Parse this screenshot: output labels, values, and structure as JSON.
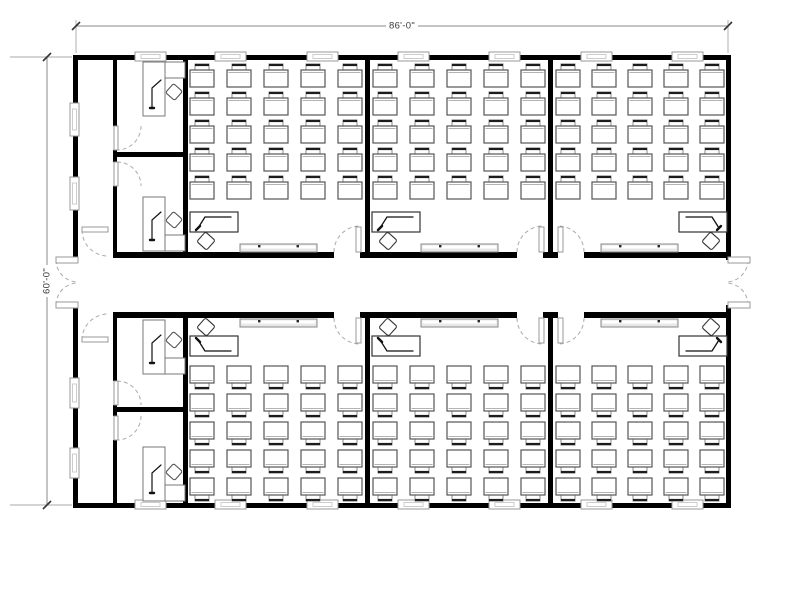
{
  "meta": {
    "drawing_type": "architectural floor plan",
    "building": "6-classroom modular building with central corridor and 4 offices"
  },
  "dimensions": {
    "top_label": "86'-0\"",
    "left_label": "60'-0\""
  },
  "colors": {
    "bg": "#ffffff",
    "wall": "#000000",
    "desk_stroke": "#555555",
    "desk_inner": "#9a9a9a",
    "chair_stroke": "#8a8a8a",
    "chair_back": "#1c1c1c",
    "teacher_stroke": "#333333",
    "arm_stroke": "#111111",
    "window_stroke": "#999999",
    "window_inner": "#cccccc",
    "door_stroke": "#999999",
    "arc_stroke": "#aaaaaa",
    "board_stroke": "#888888",
    "board_fill": "#e8e8e8",
    "board_dot": "#222222",
    "dim_line": "#888888",
    "dim_ext": "#aaaaaa",
    "dim_tick": "#333333"
  },
  "desk": {
    "w": 24,
    "h": 17,
    "chair_w": 14,
    "chair_h": 8
  },
  "walls": [
    [
      73,
      55,
      658,
      5
    ],
    [
      73,
      503,
      658,
      5
    ],
    [
      73,
      55,
      5,
      205
    ],
    [
      73,
      305,
      5,
      203
    ],
    [
      726,
      55,
      5,
      205
    ],
    [
      726,
      305,
      5,
      203
    ],
    [
      113,
      252,
      221,
      6
    ],
    [
      360,
      252,
      157,
      6
    ],
    [
      543,
      252,
      15,
      6
    ],
    [
      584,
      252,
      142,
      6
    ],
    [
      113,
      312,
      221,
      6
    ],
    [
      360,
      312,
      157,
      6
    ],
    [
      543,
      312,
      15,
      6
    ],
    [
      584,
      312,
      142,
      6
    ],
    [
      113,
      60,
      4,
      66
    ],
    [
      113,
      150,
      4,
      12
    ],
    [
      113,
      186,
      4,
      66
    ],
    [
      113,
      318,
      4,
      63
    ],
    [
      113,
      405,
      4,
      11
    ],
    [
      113,
      440,
      4,
      63
    ],
    [
      183,
      60,
      5,
      192
    ],
    [
      183,
      318,
      5,
      185
    ],
    [
      365,
      60,
      5,
      192
    ],
    [
      365,
      318,
      5,
      185
    ],
    [
      548,
      60,
      5,
      192
    ],
    [
      548,
      318,
      5,
      185
    ],
    [
      113,
      152,
      75,
      5
    ],
    [
      113,
      407,
      75,
      5
    ]
  ],
  "windows": [
    [
      135,
      52,
      31,
      9
    ],
    [
      215,
      52,
      31,
      9
    ],
    [
      307,
      52,
      31,
      9
    ],
    [
      398,
      52,
      31,
      9
    ],
    [
      489,
      52,
      31,
      9
    ],
    [
      581,
      52,
      31,
      9
    ],
    [
      672,
      52,
      31,
      9
    ],
    [
      135,
      500,
      31,
      9
    ],
    [
      215,
      500,
      31,
      9
    ],
    [
      307,
      500,
      31,
      9
    ],
    [
      398,
      500,
      31,
      9
    ],
    [
      489,
      500,
      31,
      9
    ],
    [
      581,
      500,
      31,
      9
    ],
    [
      672,
      500,
      31,
      9
    ],
    [
      70,
      103,
      9,
      33
    ],
    [
      70,
      177,
      9,
      33
    ],
    [
      70,
      378,
      9,
      30
    ],
    [
      70,
      448,
      9,
      30
    ]
  ],
  "door_leaves": [
    [
      356,
      227,
      5,
      25
    ],
    [
      539,
      227,
      5,
      25
    ],
    [
      558,
      227,
      5,
      25
    ],
    [
      356,
      318,
      5,
      25
    ],
    [
      539,
      318,
      5,
      25
    ],
    [
      558,
      318,
      5,
      25
    ],
    [
      114,
      126,
      4,
      24
    ],
    [
      114,
      162,
      4,
      24
    ],
    [
      114,
      381,
      4,
      24
    ],
    [
      114,
      416,
      4,
      24
    ],
    [
      82,
      227,
      26,
      5
    ],
    [
      82,
      337,
      26,
      5
    ],
    [
      56,
      257,
      22,
      6
    ],
    [
      56,
      302,
      22,
      6
    ],
    [
      728,
      257,
      22,
      6
    ],
    [
      728,
      302,
      22,
      6
    ]
  ],
  "door_arcs": [
    "M 334 252 A 26 26 0 0 1 360 226",
    "M 517 252 A 26 26 0 0 1 543 226",
    "M 584 252 A 26 26 0 0 0 558 226",
    "M 334 318 A 26 26 0 0 0 360 344",
    "M 517 318 A 26 26 0 0 0 543 344",
    "M 584 318 A 26 26 0 0 1 558 344",
    "M 141 126 A 24 24 0 0 1 117 150",
    "M 117 162 A 24 24 0 0 1 141 186",
    "M 117 381 A 24 24 0 0 1 141 405",
    "M 141 416 A 24 24 0 0 1 117 440",
    "M 82 230 A 26 26 0 0 0 108 256",
    "M 82 340 A 26 26 0 0 1 108 314",
    "M 56 260 A 22 22 0 0 0 78 282",
    "M 56 305 A 22 22 0 0 1 78 283",
    "M 748 260 A 22 22 0 0 1 726 282",
    "M 748 305 A 22 22 0 0 0 726 283"
  ],
  "whiteboards": {
    "w": 77,
    "h": 8,
    "items": [
      [
        240,
        244
      ],
      [
        421,
        244
      ],
      [
        601,
        244
      ],
      [
        240,
        319
      ],
      [
        421,
        319
      ],
      [
        601,
        319
      ]
    ]
  },
  "classrooms": [
    {
      "id": "classroom-1",
      "chair_side": "top",
      "cols": [
        190,
        227,
        264,
        301,
        338
      ],
      "rows": [
        70,
        98,
        126,
        154,
        182
      ],
      "teacher": {
        "desk": [
          190,
          212,
          48,
          20
        ],
        "chair": [
          206,
          241
        ],
        "hand": "left"
      }
    },
    {
      "id": "classroom-2",
      "chair_side": "top",
      "cols": [
        373,
        410,
        447,
        484,
        521
      ],
      "rows": [
        70,
        98,
        126,
        154,
        182
      ],
      "teacher": {
        "desk": [
          372,
          212,
          48,
          20
        ],
        "chair": [
          388,
          241
        ],
        "hand": "left"
      }
    },
    {
      "id": "classroom-3",
      "chair_side": "top",
      "cols": [
        556,
        592,
        628,
        664,
        700
      ],
      "rows": [
        70,
        98,
        126,
        154,
        182
      ],
      "teacher": {
        "desk": [
          679,
          212,
          48,
          20
        ],
        "chair": [
          711,
          241
        ],
        "hand": "right"
      }
    },
    {
      "id": "classroom-4",
      "chair_side": "bottom",
      "cols": [
        190,
        227,
        264,
        301,
        338
      ],
      "rows": [
        366,
        394,
        422,
        450,
        478
      ],
      "teacher": {
        "desk": [
          190,
          336,
          48,
          20
        ],
        "chair": [
          206,
          327
        ],
        "hand": "left"
      }
    },
    {
      "id": "classroom-5",
      "chair_side": "bottom",
      "cols": [
        373,
        410,
        447,
        484,
        521
      ],
      "rows": [
        366,
        394,
        422,
        450,
        478
      ],
      "teacher": {
        "desk": [
          372,
          336,
          48,
          20
        ],
        "chair": [
          388,
          327
        ],
        "hand": "left"
      }
    },
    {
      "id": "classroom-6",
      "chair_side": "bottom",
      "cols": [
        556,
        592,
        628,
        664,
        700
      ],
      "rows": [
        366,
        394,
        422,
        450,
        478
      ],
      "teacher": {
        "desk": [
          679,
          336,
          48,
          20
        ],
        "chair": [
          711,
          327
        ],
        "hand": "right"
      }
    }
  ],
  "offices": [
    {
      "id": "office-1",
      "v_desk": [
        143,
        62,
        22,
        54
      ],
      "return_desk": [
        165,
        62,
        20,
        16
      ],
      "chair": [
        174,
        92
      ],
      "arm": [
        [
          152,
          108
        ],
        [
          152,
          88
        ],
        [
          161,
          80
        ]
      ]
    },
    {
      "id": "office-2",
      "v_desk": [
        143,
        197,
        22,
        54
      ],
      "return_desk": [
        165,
        235,
        20,
        16
      ],
      "chair": [
        174,
        220
      ],
      "arm": [
        [
          152,
          240
        ],
        [
          152,
          220
        ],
        [
          161,
          212
        ]
      ]
    },
    {
      "id": "office-3",
      "v_desk": [
        143,
        320,
        22,
        54
      ],
      "return_desk": [
        165,
        358,
        20,
        16
      ],
      "chair": [
        174,
        340
      ],
      "arm": [
        [
          152,
          363
        ],
        [
          152,
          343
        ],
        [
          161,
          335
        ]
      ]
    },
    {
      "id": "office-4",
      "v_desk": [
        143,
        447,
        22,
        54
      ],
      "return_desk": [
        165,
        485,
        20,
        16
      ],
      "chair": [
        174,
        472
      ],
      "arm": [
        [
          152,
          493
        ],
        [
          152,
          473
        ],
        [
          161,
          465
        ]
      ]
    }
  ],
  "dim": {
    "h_line": [
      76,
      26,
      728,
      26
    ],
    "h_ext": [
      [
        76,
        20,
        76,
        53
      ],
      [
        728,
        20,
        728,
        53
      ]
    ],
    "h_ticks": [
      [
        72,
        30,
        80,
        22
      ],
      [
        724,
        30,
        732,
        22
      ]
    ],
    "h_label_pos": [
      402,
      26
    ],
    "v_line": [
      47,
      57,
      47,
      505
    ],
    "v_ext": [
      [
        10,
        57,
        72,
        57
      ],
      [
        10,
        505,
        72,
        505
      ]
    ],
    "v_ticks": [
      [
        43,
        61,
        51,
        53
      ],
      [
        43,
        509,
        51,
        501
      ]
    ],
    "v_label_pos": [
      47,
      281
    ]
  }
}
